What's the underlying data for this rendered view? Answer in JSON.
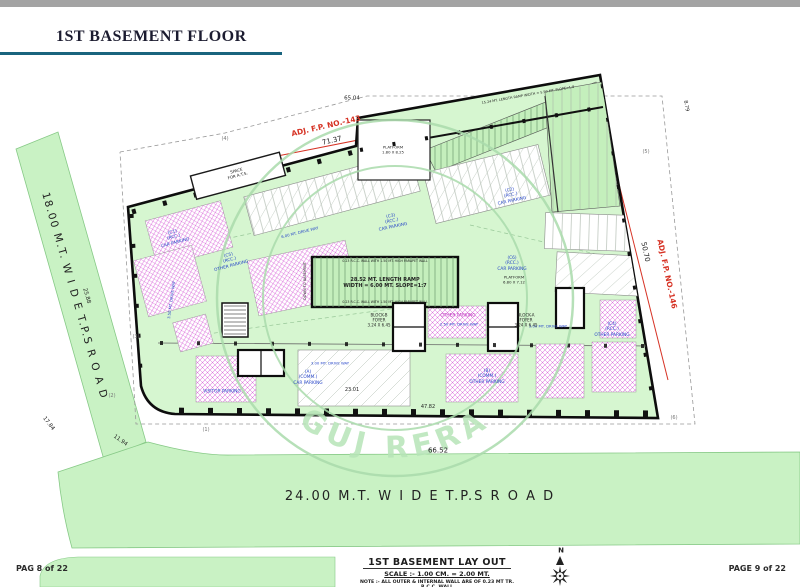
{
  "header": {
    "title": "1ST BASEMENT FLOOR"
  },
  "footer": {
    "left": "PAG 8 of 22",
    "right": "PAGE 9 of 22"
  },
  "title_block": {
    "title": "1ST BASEMENT LAY OUT",
    "scale": "SCALE :- 1.00 CM. = 2.00 MT.",
    "note": "NOTE :- ALL OUTER & INTERNAL WALL ARE OF 0.23 MT TR. R.C.C. WALL"
  },
  "watermark": {
    "text": "GUJ RERA"
  },
  "colors": {
    "black": "#222222",
    "gray": "#777777",
    "blue": "#2746c8",
    "magenta": "#bb2dbb",
    "red": "#d63224",
    "wm": "#b7e5b8",
    "road_green": "#c9f2c4",
    "plan_green": "#d6f6d0",
    "ramp_green": "#c4efbc",
    "teal_rule": "#19647e"
  },
  "plan": {
    "labels": [
      {
        "name": "road-left-label",
        "t": "18.00   M.T.   W I D E   T.P.S   R O A D",
        "x": 74,
        "y": 296,
        "r": 74,
        "s": 10.5,
        "ls": 1.5
      },
      {
        "name": "road-bottom-label",
        "t": "24.00   M.T.   W I D E   T.P.S   R O A D",
        "x": 420,
        "y": 497,
        "r": 0,
        "s": 13,
        "ls": 2
      },
      {
        "name": "adj-fp-top-label",
        "t": "ADJ. F.P. NO.-143",
        "x": 326,
        "y": 126,
        "r": -13,
        "s": 7.5,
        "c": "red",
        "b": 1
      },
      {
        "name": "adj-fp-right-label",
        "t": "ADJ. F.P. NO.-146",
        "x": 667,
        "y": 274,
        "r": 78,
        "s": 7.5,
        "c": "red",
        "b": 1
      },
      {
        "name": "dim-71-37",
        "t": "71.37",
        "x": 332,
        "y": 141,
        "r": -13,
        "s": 7
      },
      {
        "name": "dim-65-04",
        "t": "65.04",
        "x": 352,
        "y": 99,
        "r": 0,
        "s": 5.5
      },
      {
        "name": "dim-50-70",
        "t": "50.70",
        "x": 645,
        "y": 252,
        "r": 78,
        "s": 7
      },
      {
        "name": "dim-66-52",
        "t": "66.52",
        "x": 438,
        "y": 451,
        "r": 0,
        "s": 7
      },
      {
        "name": "dim-25-88",
        "t": "25.88",
        "x": 86,
        "y": 296,
        "r": 74,
        "s": 5.5
      },
      {
        "name": "dim-17-84",
        "t": "17.84",
        "x": 48,
        "y": 424,
        "r": 52,
        "s": 5.5
      },
      {
        "name": "dim-11-94",
        "t": "11.94",
        "x": 120,
        "y": 441,
        "r": 35,
        "s": 5.5
      },
      {
        "name": "dim-23-01",
        "t": "23.01",
        "x": 352,
        "y": 390,
        "r": 0,
        "s": 5
      },
      {
        "name": "dim-47-82",
        "t": "47.82",
        "x": 428,
        "y": 407,
        "r": 0,
        "s": 5
      },
      {
        "name": "dim-8-79",
        "t": "8.79",
        "x": 686,
        "y": 106,
        "r": 80,
        "s": 5
      },
      {
        "name": "boundary-point-1",
        "t": "(1)",
        "x": 206,
        "y": 430,
        "r": 0,
        "s": 5,
        "c": "gray"
      },
      {
        "name": "boundary-point-2",
        "t": "(2)",
        "x": 112,
        "y": 396,
        "r": 0,
        "s": 5,
        "c": "gray"
      },
      {
        "name": "boundary-point-3",
        "t": "(3)",
        "x": 136,
        "y": 337,
        "r": 0,
        "s": 5,
        "c": "gray"
      },
      {
        "name": "boundary-point-4",
        "t": "(4)",
        "x": 225,
        "y": 139,
        "r": 0,
        "s": 5,
        "c": "gray"
      },
      {
        "name": "boundary-point-5",
        "t": "(5)",
        "x": 646,
        "y": 152,
        "r": 0,
        "s": 5,
        "c": "gray"
      },
      {
        "name": "boundary-point-6",
        "t": "(6)",
        "x": 674,
        "y": 418,
        "r": 0,
        "s": 5,
        "c": "gray"
      },
      {
        "name": "zone-c1-label",
        "t": "(C1)\n(RCC.)\nCAR PARKING",
        "x": 174,
        "y": 238,
        "r": -15,
        "s": 4.3,
        "c": "blue"
      },
      {
        "name": "zone-c3-label",
        "t": "(C3)\n(RCC.)\nCAR PARKING",
        "x": 392,
        "y": 222,
        "r": -12,
        "s": 4.3,
        "c": "blue"
      },
      {
        "name": "zone-c2-label",
        "t": "(C2)\n(RCC.)\nCAR PARKING",
        "x": 511,
        "y": 196,
        "r": -12,
        "s": 4.3,
        "c": "blue"
      },
      {
        "name": "zone-c6-label",
        "t": "(C6)\n(RCC.)\nCAR PARKING",
        "x": 512,
        "y": 264,
        "r": 0,
        "s": 4.3,
        "c": "blue"
      },
      {
        "name": "zone-c4-label",
        "t": "(C4)\n(RCC.)\nOTHER PARKING",
        "x": 612,
        "y": 330,
        "r": 0,
        "s": 4.3,
        "c": "blue"
      },
      {
        "name": "zone-c5-label",
        "t": "(C5)\n(RCC.)\nOTHER PARKING",
        "x": 230,
        "y": 261,
        "r": -15,
        "s": 4.3,
        "c": "blue"
      },
      {
        "name": "zone-a-label",
        "t": "(A)\n(COMM.)\nCAR PARKING",
        "x": 308,
        "y": 378,
        "r": 0,
        "s": 4.3,
        "c": "blue"
      },
      {
        "name": "zone-b-label",
        "t": "(B)\n(COMM.)\nOTHER PARKING",
        "x": 487,
        "y": 377,
        "r": 0,
        "s": 4.3,
        "c": "blue"
      },
      {
        "name": "visitor-parking-label",
        "t": "VISITOR PARKING",
        "x": 222,
        "y": 392,
        "r": 0,
        "s": 4.3,
        "c": "blue"
      },
      {
        "name": "other-parking-center-label",
        "t": "OTHER PARKING",
        "x": 458,
        "y": 316,
        "r": 0,
        "s": 4.3,
        "c": "magenta"
      },
      {
        "name": "driveway-250-label",
        "t": "2.50 MT.  DRIVE WAY",
        "x": 459,
        "y": 325,
        "r": 0,
        "s": 3.8,
        "c": "blue"
      },
      {
        "name": "driveway-600-label",
        "t": "6.00 MT.  DRIVE WAY",
        "x": 300,
        "y": 233,
        "r": -14,
        "s": 3.8,
        "c": "blue"
      },
      {
        "name": "driveway-350-label",
        "t": "3.50 MT.  DRIVE WAY",
        "x": 172,
        "y": 300,
        "r": -82,
        "s": 3.8,
        "c": "blue"
      },
      {
        "name": "driveway-300a-label",
        "t": "3.00 MT.  DRIVE WAY",
        "x": 330,
        "y": 364,
        "r": 0,
        "s": 3.8,
        "c": "blue"
      },
      {
        "name": "driveway-300b-label",
        "t": "3.00 MT.  DRIVE WAY",
        "x": 548,
        "y": 327,
        "r": 0,
        "s": 3.8,
        "c": "blue"
      },
      {
        "name": "platform-top-label",
        "t": "PLATFORM\n1.80 X 8.25",
        "x": 393,
        "y": 150,
        "r": 0,
        "s": 3.8
      },
      {
        "name": "platform-right-label",
        "t": "PLATFORM\n6.80 X 7.12",
        "x": 514,
        "y": 280,
        "r": 0,
        "s": 3.8
      },
      {
        "name": "block-b-foyer-label",
        "t": "BLOCK-B\nFOYER\n3.24 X 6.45",
        "x": 379,
        "y": 320,
        "r": 0,
        "s": 4
      },
      {
        "name": "block-a-foyer-label",
        "t": "BLOCK-A\nFOYER\n3.24 X 6.45",
        "x": 526,
        "y": 320,
        "r": 0,
        "s": 4
      },
      {
        "name": "space-box-label",
        "t": "SPACE\nFOR A.T.S.",
        "x": 237,
        "y": 173,
        "r": -15,
        "s": 4
      },
      {
        "name": "down-to-basement-label",
        "t": "DOWN TO BASEMENT",
        "x": 305,
        "y": 281,
        "r": -90,
        "s": 3.5
      },
      {
        "name": "ramp-main-label",
        "t": "28.52 MT.  LENGTH RAMP\nWIDTH = 6.00 MT. SLOPE=1:7",
        "x": 385,
        "y": 283,
        "r": 0,
        "s": 5,
        "b": 1
      },
      {
        "name": "ramp-top-label",
        "t": "15.24 MT. LENGTH RAMP WIDTH = 5.50 MT. SLOPE=1:8",
        "x": 528,
        "y": 95,
        "r": -10,
        "s": 3.4
      },
      {
        "name": "parapet-note-top",
        "t": "0.23 R.C.C. WALL WITH 1.50 MT. HIGH PARAPET WALL",
        "x": 385,
        "y": 261,
        "r": 0,
        "s": 3.2
      },
      {
        "name": "parapet-note-bottom",
        "t": "0.23 R.C.C. WALL WITH 1.50 MT. HIGH PARAPET WALL",
        "x": 385,
        "y": 302,
        "r": 0,
        "s": 3.2
      },
      {
        "name": "north-label",
        "t": "N",
        "x": 561,
        "y": 551,
        "r": 0,
        "s": 7,
        "b": 1
      }
    ]
  }
}
